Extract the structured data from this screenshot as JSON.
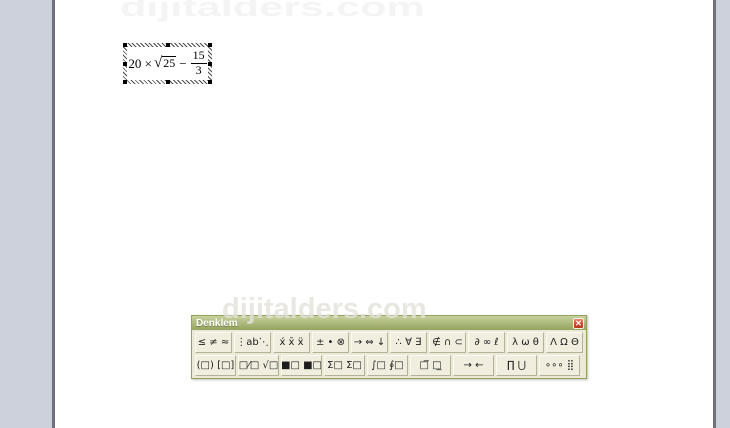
{
  "watermark": {
    "text": "dijitalders.com"
  },
  "equation_object": {
    "lhs": "20 ×",
    "sqrt_radicand": "25",
    "operator": "−",
    "fraction": {
      "numerator": "15",
      "denominator": "3"
    }
  },
  "toolbar": {
    "title": "Denklem",
    "close_glyph": "✕",
    "colors": {
      "titlebar_olive": "#9aa968",
      "face_beige": "#ece9d8",
      "close_red": "#cf4931"
    },
    "rows": [
      {
        "name": "symbol-palettes",
        "buttons": [
          {
            "name": "palette-relational-symbols",
            "label": "≤ ≠ ≈"
          },
          {
            "name": "palette-spaces-ellipses",
            "label": "⋮ab⋱"
          },
          {
            "name": "palette-embellishments",
            "label": "x́ x̄ ẍ"
          },
          {
            "name": "palette-operator-symbols",
            "label": "± • ⊗"
          },
          {
            "name": "palette-arrow-symbols",
            "label": "→ ⇔ ↓"
          },
          {
            "name": "palette-logical-symbols",
            "label": "∴ ∀ ∃"
          },
          {
            "name": "palette-set-theory-symbols",
            "label": "∉ ∩ ⊂"
          },
          {
            "name": "palette-misc-symbols",
            "label": "∂ ∞ ℓ"
          },
          {
            "name": "palette-greek-lowercase",
            "label": "λ ω θ"
          },
          {
            "name": "palette-greek-uppercase",
            "label": "Λ Ω Θ"
          }
        ]
      },
      {
        "name": "template-palettes",
        "buttons": [
          {
            "name": "palette-fence-templates",
            "label": "(□) [□]"
          },
          {
            "name": "palette-fraction-radical-templates",
            "label": "□⁄□ √□"
          },
          {
            "name": "palette-subscript-superscript-templates",
            "label": "■□ ■□"
          },
          {
            "name": "palette-summation-templates",
            "label": "Σ□ Σ□"
          },
          {
            "name": "palette-integral-templates",
            "label": "∫□ ∮□"
          },
          {
            "name": "palette-underbar-overbar-templates",
            "label": "□̅ □̲"
          },
          {
            "name": "palette-labeled-arrow-templates",
            "label": "→ ←"
          },
          {
            "name": "palette-product-set-templates",
            "label": "∏ ⋃"
          },
          {
            "name": "palette-matrix-templates",
            "label": "∘∘∘ ⣿"
          }
        ]
      }
    ]
  }
}
